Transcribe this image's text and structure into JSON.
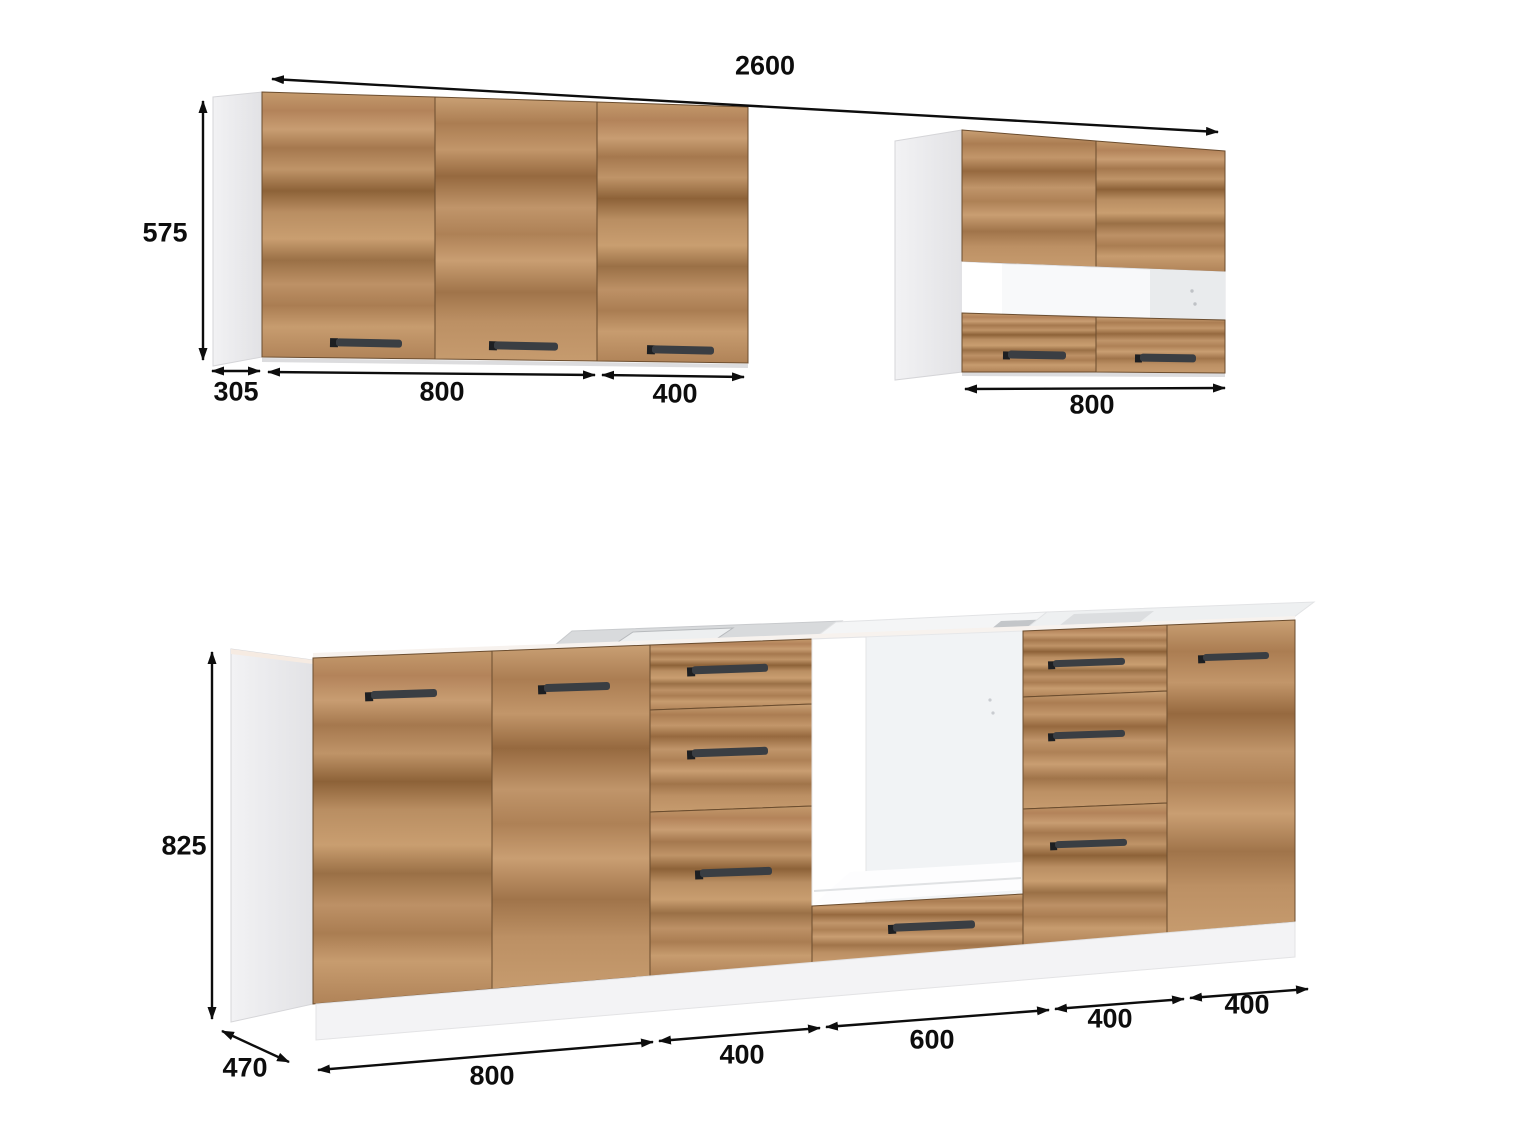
{
  "drawing": {
    "background_color": "#ffffff",
    "dimension_color": "#0d0d0d",
    "wood_color": "#b8895d",
    "carcass_color": "#ededef",
    "handle_color": "#3a3e43"
  },
  "dimensions": {
    "total_width": "2600",
    "wall_cabinet_left": {
      "height": "575",
      "depth": "305",
      "segments": [
        "800",
        "400"
      ]
    },
    "wall_cabinet_right": {
      "width": "800"
    },
    "base_run": {
      "height": "825",
      "depth": "470",
      "segments": [
        "800",
        "400",
        "600",
        "400",
        "400"
      ]
    }
  }
}
